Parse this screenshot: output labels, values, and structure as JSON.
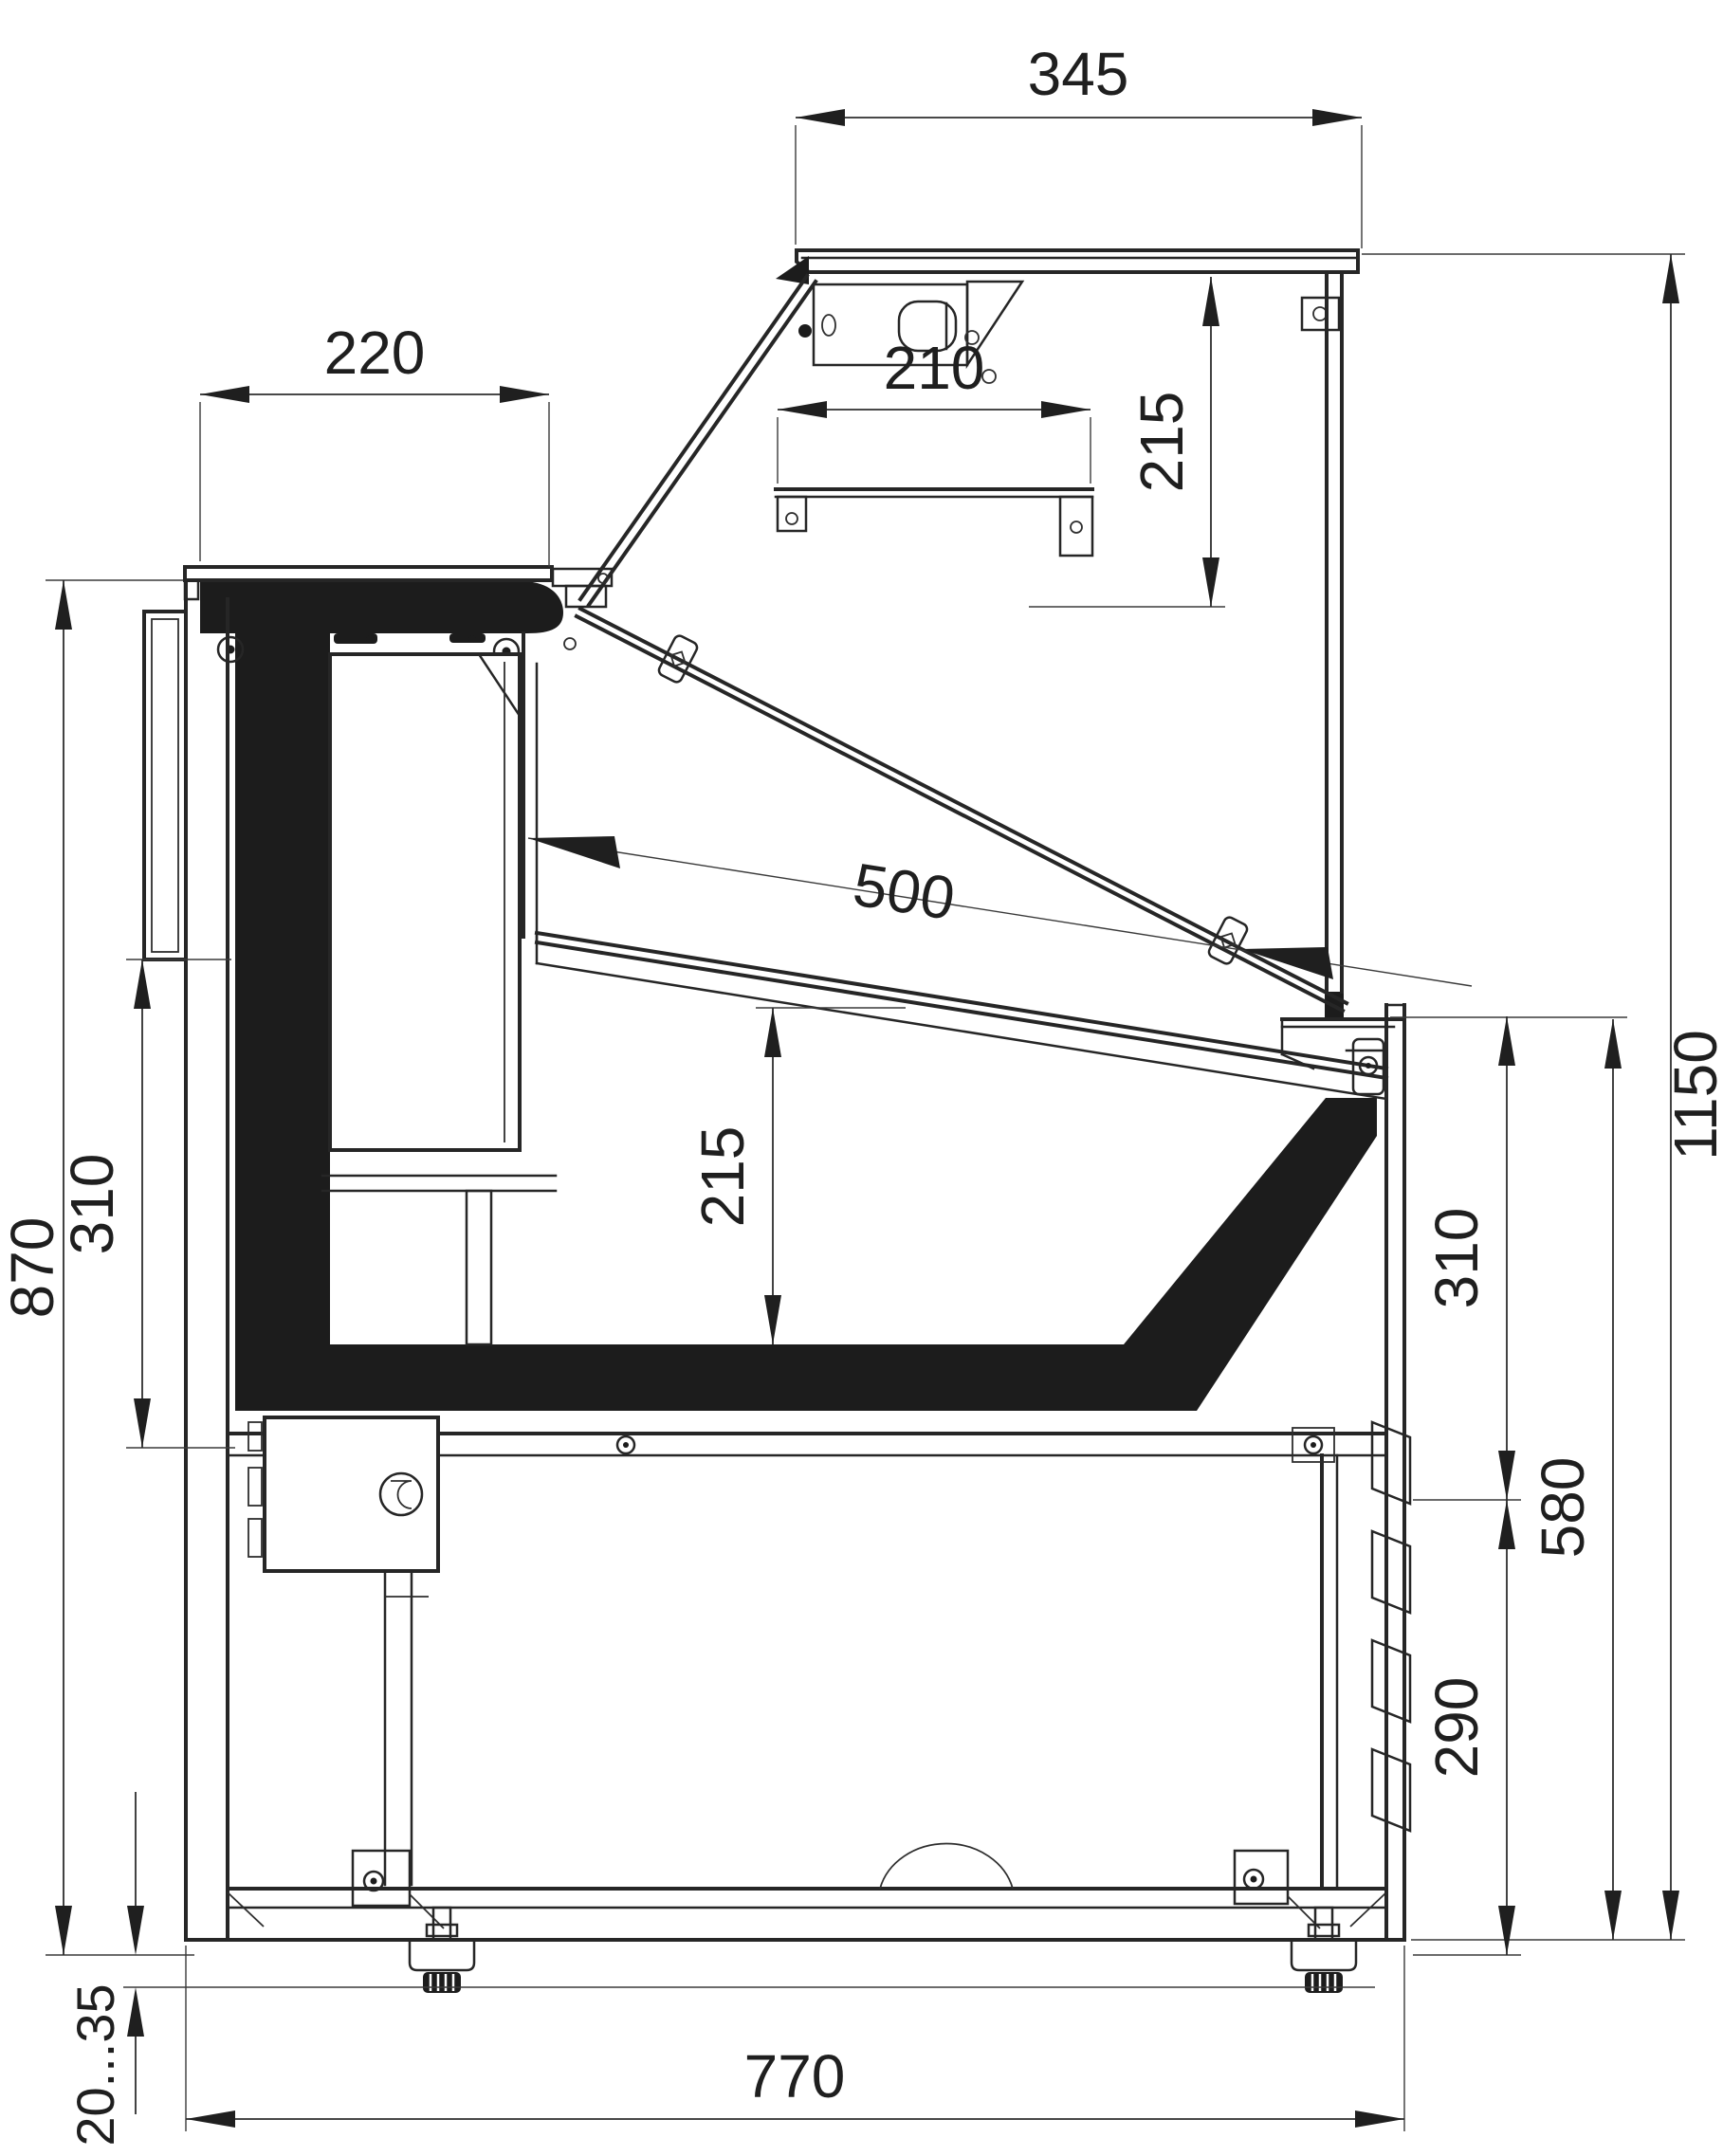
{
  "drawing": {
    "type": "technical-cross-section",
    "subject": "refrigerated-display-counter-side-section",
    "background": "#ffffff",
    "line_color": "#262626",
    "fill_color": "#1c1c1c",
    "dims": {
      "canopy_depth": "345",
      "canopy_to_shelf": "215",
      "worktop_depth": "220",
      "shelf_depth": "210",
      "display_depth": "500",
      "front_lower_panel_height": "310",
      "well_depth": "215",
      "front_counter_height": "870",
      "total_height": "1150",
      "back_upper_section_height": "310",
      "back_mid_section_height": "580",
      "back_vent_section_height": "290",
      "body_depth": "770",
      "feet_adjust_range": "20...35"
    }
  }
}
